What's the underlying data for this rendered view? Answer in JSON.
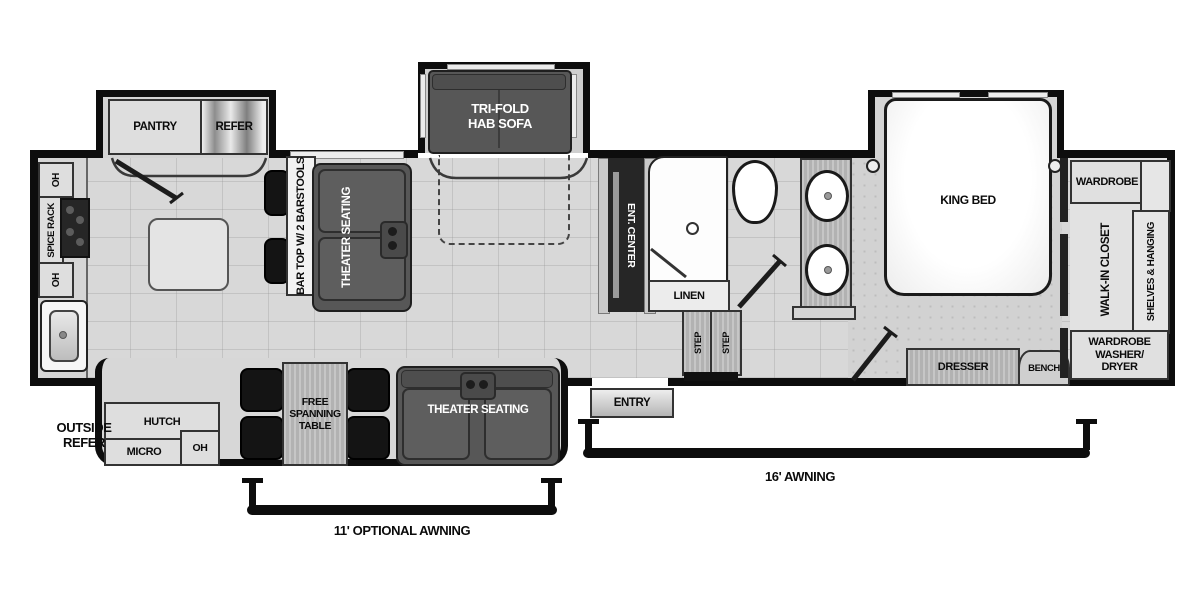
{
  "kitchen": {
    "oh_upper": "OH",
    "spice_rack": "SPICE RACK",
    "oh_lower": "OH",
    "pantry": "PANTRY",
    "refer": "REFER",
    "bar_top": "BAR TOP W/ 2 BARSTOOLS"
  },
  "living": {
    "theater_seating": "THEATER SEATING",
    "tri_fold_sofa": "TRI-FOLD\nHAB SOFA",
    "ent_center": "ENT. CENTER"
  },
  "dinette": {
    "hutch": "HUTCH",
    "micro": "MICRO",
    "oh": "OH",
    "table": "FREE\nSPANNING\nTABLE",
    "theater_seating": "THEATER SEATING"
  },
  "bath": {
    "linen": "LINEN",
    "step_left": "STEP",
    "step_right": "STEP"
  },
  "bedroom": {
    "king_bed": "KING BED",
    "dresser": "DRESSER",
    "bench": "BENCH"
  },
  "closet": {
    "wardrobe": "WARDROBE",
    "walk_in": "WALK-IN CLOSET",
    "shelves": "SHELVES & HANGING",
    "washer_dryer": "WARDROBE\nWASHER/\nDRYER"
  },
  "exterior": {
    "outside_refer": "OUTSIDE\nREFER",
    "entry": "ENTRY",
    "awning_16": "16' AWNING",
    "awning_11": "11' OPTIONAL AWNING"
  },
  "colors": {
    "wall": "#0d0d0d",
    "furniture_dark": "#575757"
  }
}
